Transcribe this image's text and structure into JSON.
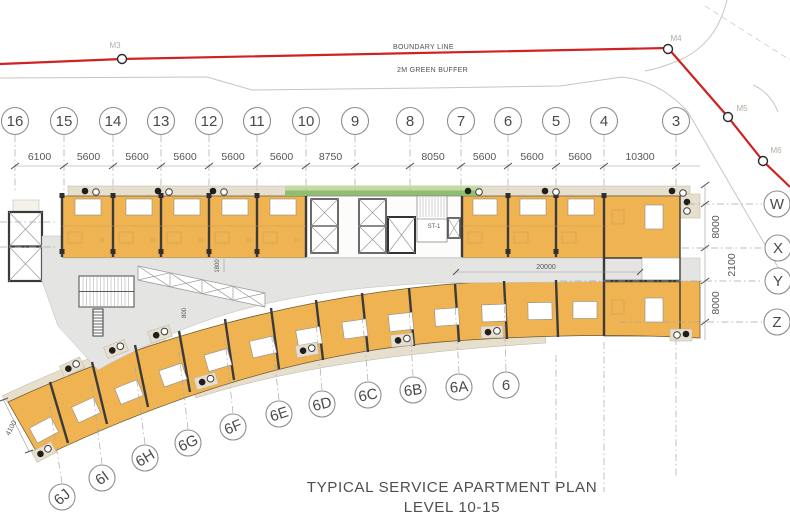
{
  "title": {
    "line1": "TYPICAL SERVICE APARTMENT PLAN",
    "line2": "LEVEL 10-15"
  },
  "site": {
    "boundary_label": "BOUNDARY LINE",
    "buffer_label": "2M GREEN BUFFER",
    "markers": [
      "M3",
      "M4",
      "M5",
      "M6"
    ]
  },
  "grid": {
    "top_bubbles": [
      "16",
      "15",
      "14",
      "13",
      "12",
      "11",
      "10",
      "9",
      "8",
      "7",
      "6",
      "5",
      "4",
      "3"
    ],
    "top_dimensions": [
      "6100",
      "5600",
      "5600",
      "5600",
      "5600",
      "5600",
      "8750",
      "8050",
      "5600",
      "5600",
      "5600",
      "10300"
    ],
    "right_bubbles": [
      "W",
      "X",
      "Y",
      "Z"
    ],
    "right_dimensions": [
      "8000",
      "2100",
      "8000"
    ],
    "bottom_bubbles": [
      "6J",
      "6I",
      "6H",
      "6G",
      "6F",
      "6E",
      "6D",
      "6C",
      "6B",
      "6A",
      "6"
    ]
  },
  "plan": {
    "stair_label": "ST-1",
    "corridor_length_dim": "20000",
    "corridor_width_dim": "1800",
    "walkway_dim": "800",
    "end_bay_dim": "4100",
    "colors": {
      "unit_fill": "#f0b351",
      "balcony_fill": "#e7dfcd",
      "corridor_fill": "#e4e4e2",
      "planter_green": "#8fbe72",
      "boundary_red": "#cf2222"
    }
  }
}
